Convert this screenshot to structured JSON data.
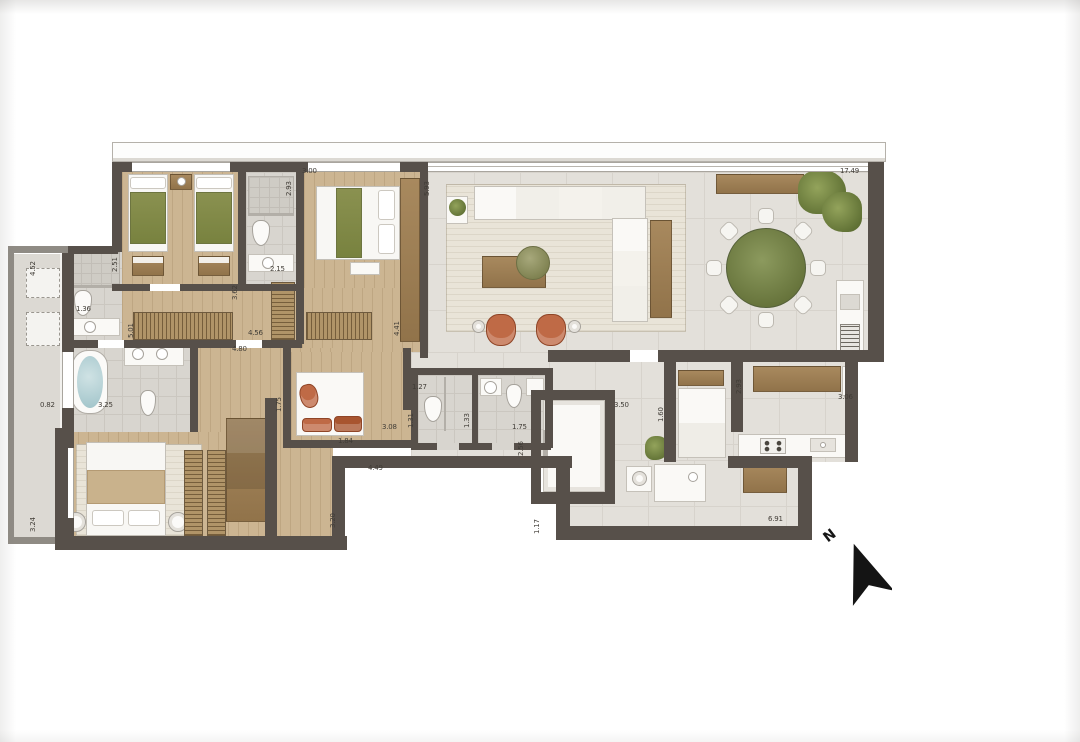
{
  "compass": {
    "label": "N"
  },
  "colors": {
    "wall": "#57504a",
    "wood_floor": "#ccb592",
    "tile_floor": "#e3e0da",
    "bath_floor": "#d8d5cf",
    "balcony_floor": "#dcd9d3",
    "accent_green": "#8a9150",
    "terracotta": "#bf6a46",
    "hatch_wood": "#b09468",
    "water_blue": "#9fc3c9"
  },
  "dimension_labels": [
    {
      "text": "4.52",
      "x": 30,
      "y": 276,
      "rot": -90
    },
    {
      "text": "0.82",
      "x": 40,
      "y": 402,
      "rot": 0
    },
    {
      "text": "3.24",
      "x": 30,
      "y": 532,
      "rot": -90
    },
    {
      "text": "2.51",
      "x": 112,
      "y": 272,
      "rot": -90
    },
    {
      "text": "1.36",
      "x": 76,
      "y": 306,
      "rot": 0
    },
    {
      "text": "3.25",
      "x": 98,
      "y": 402,
      "rot": 0
    },
    {
      "text": "1.75",
      "x": 276,
      "y": 412,
      "rot": -90
    },
    {
      "text": "2.93",
      "x": 286,
      "y": 196,
      "rot": -90
    },
    {
      "text": "3.00",
      "x": 302,
      "y": 168,
      "rot": 0
    },
    {
      "text": "2.15",
      "x": 270,
      "y": 266,
      "rot": 0
    },
    {
      "text": "5.93",
      "x": 424,
      "y": 196,
      "rot": -90
    },
    {
      "text": "5.01",
      "x": 128,
      "y": 338,
      "rot": -90
    },
    {
      "text": "3.62",
      "x": 232,
      "y": 300,
      "rot": -90
    },
    {
      "text": "4.56",
      "x": 248,
      "y": 330,
      "rot": 0
    },
    {
      "text": "4.80",
      "x": 232,
      "y": 346,
      "rot": 0
    },
    {
      "text": "4.41",
      "x": 394,
      "y": 336,
      "rot": -90
    },
    {
      "text": "3.08",
      "x": 382,
      "y": 424,
      "rot": 0
    },
    {
      "text": "1.84",
      "x": 338,
      "y": 438,
      "rot": 0
    },
    {
      "text": "1.27",
      "x": 412,
      "y": 384,
      "rot": 0
    },
    {
      "text": "1.31",
      "x": 408,
      "y": 428,
      "rot": -90
    },
    {
      "text": "1.33",
      "x": 464,
      "y": 428,
      "rot": -90
    },
    {
      "text": "1.75",
      "x": 512,
      "y": 424,
      "rot": 0
    },
    {
      "text": "2.56",
      "x": 518,
      "y": 456,
      "rot": -90
    },
    {
      "text": "3.50",
      "x": 614,
      "y": 402,
      "rot": 0
    },
    {
      "text": "1.60",
      "x": 658,
      "y": 422,
      "rot": -90
    },
    {
      "text": "2.93",
      "x": 736,
      "y": 394,
      "rot": -90
    },
    {
      "text": "3.06",
      "x": 838,
      "y": 394,
      "rot": 0
    },
    {
      "text": "17.49",
      "x": 840,
      "y": 168,
      "rot": 0
    },
    {
      "text": "4.49",
      "x": 368,
      "y": 465,
      "rot": 0
    },
    {
      "text": "3.20",
      "x": 330,
      "y": 528,
      "rot": -90
    },
    {
      "text": "1.17",
      "x": 534,
      "y": 534,
      "rot": -90
    },
    {
      "text": "6.91",
      "x": 768,
      "y": 516,
      "rot": 0
    }
  ]
}
